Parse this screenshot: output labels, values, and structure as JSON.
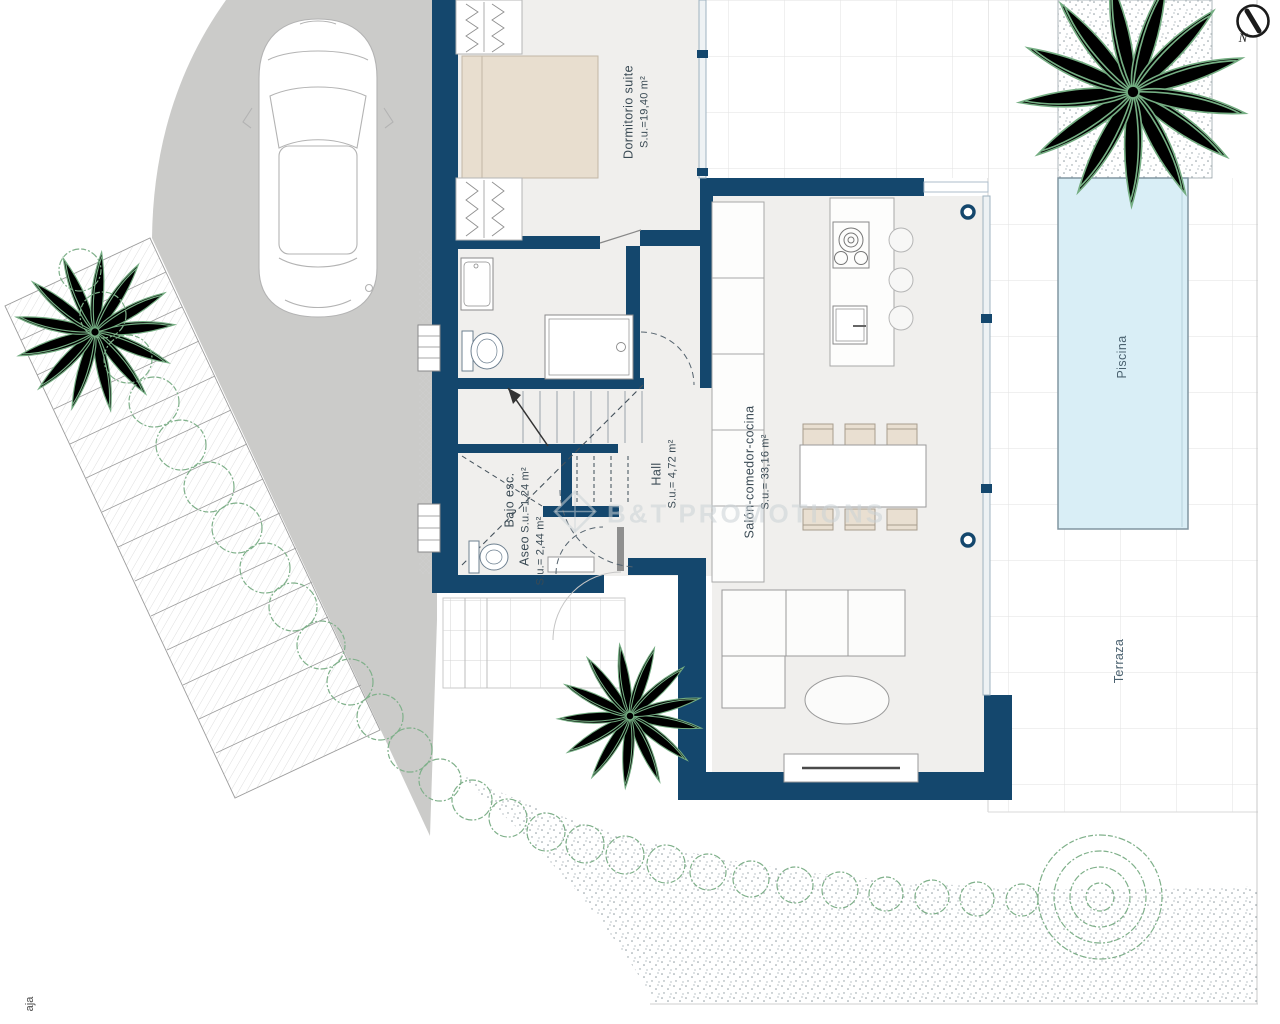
{
  "plan_title": "Villa ground floor plan",
  "labels": {
    "dormitorio": {
      "name": "Dormitorio suite",
      "area": "S.u.=19,40 m²"
    },
    "hall": {
      "name": "Hall",
      "area": "S.u.= 4,72 m²"
    },
    "salon": {
      "name": "Salón-comedor-cocina",
      "area": "S.u.= 33,16 m²"
    },
    "bajo_esc": {
      "name": "Bajo esc.",
      "area": "S.u.=1,24 m²"
    },
    "aseo": {
      "name": "Aseo",
      "area": "S.u.= 2,44 m²"
    },
    "piscina": {
      "name": "Piscina"
    },
    "terraza": {
      "name": "Terraza"
    }
  },
  "compass": {
    "label": "N"
  },
  "watermark": {
    "brand": "B&T",
    "suffix": "PROMOTIONS"
  },
  "edge_text": "aja",
  "colors": {
    "wall": "#14476d",
    "floor": "#f0efed",
    "driveway": "#cbcbc9",
    "pool": "#d9eef6",
    "plant": "#74ad82",
    "bed": "#e8decf"
  }
}
